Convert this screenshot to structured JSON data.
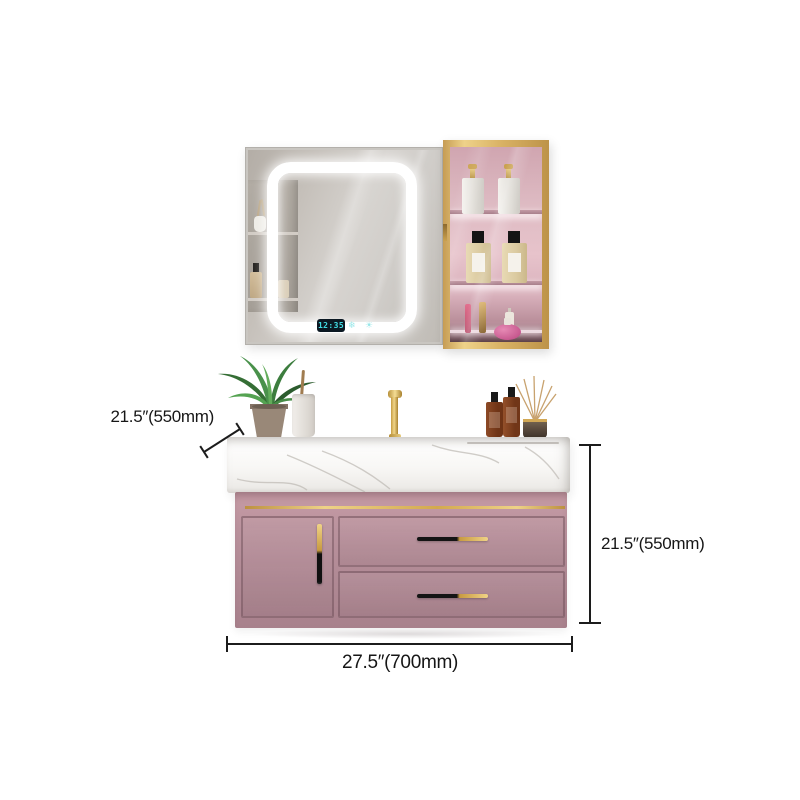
{
  "annotations": {
    "depth_label": "21.5″(550mm)",
    "height_label": "21.5″(550mm)",
    "width_label": "27.5″(700mm)"
  },
  "smart_mirror": {
    "clock_time": "12:35",
    "touch_icons": [
      {
        "name": "defogger-icon",
        "glyph": "❄"
      },
      {
        "name": "temperature-icon",
        "glyph": "☀"
      }
    ]
  },
  "palette": {
    "vanity_pink": "#b28b96",
    "gold_accent": "#d9ae58",
    "led_cyan": "#41dce4",
    "cabinet_interior_pink": "#e0b6c0",
    "counter_white": "#f7f6f3",
    "dimension_line": "#1c1c1c"
  }
}
